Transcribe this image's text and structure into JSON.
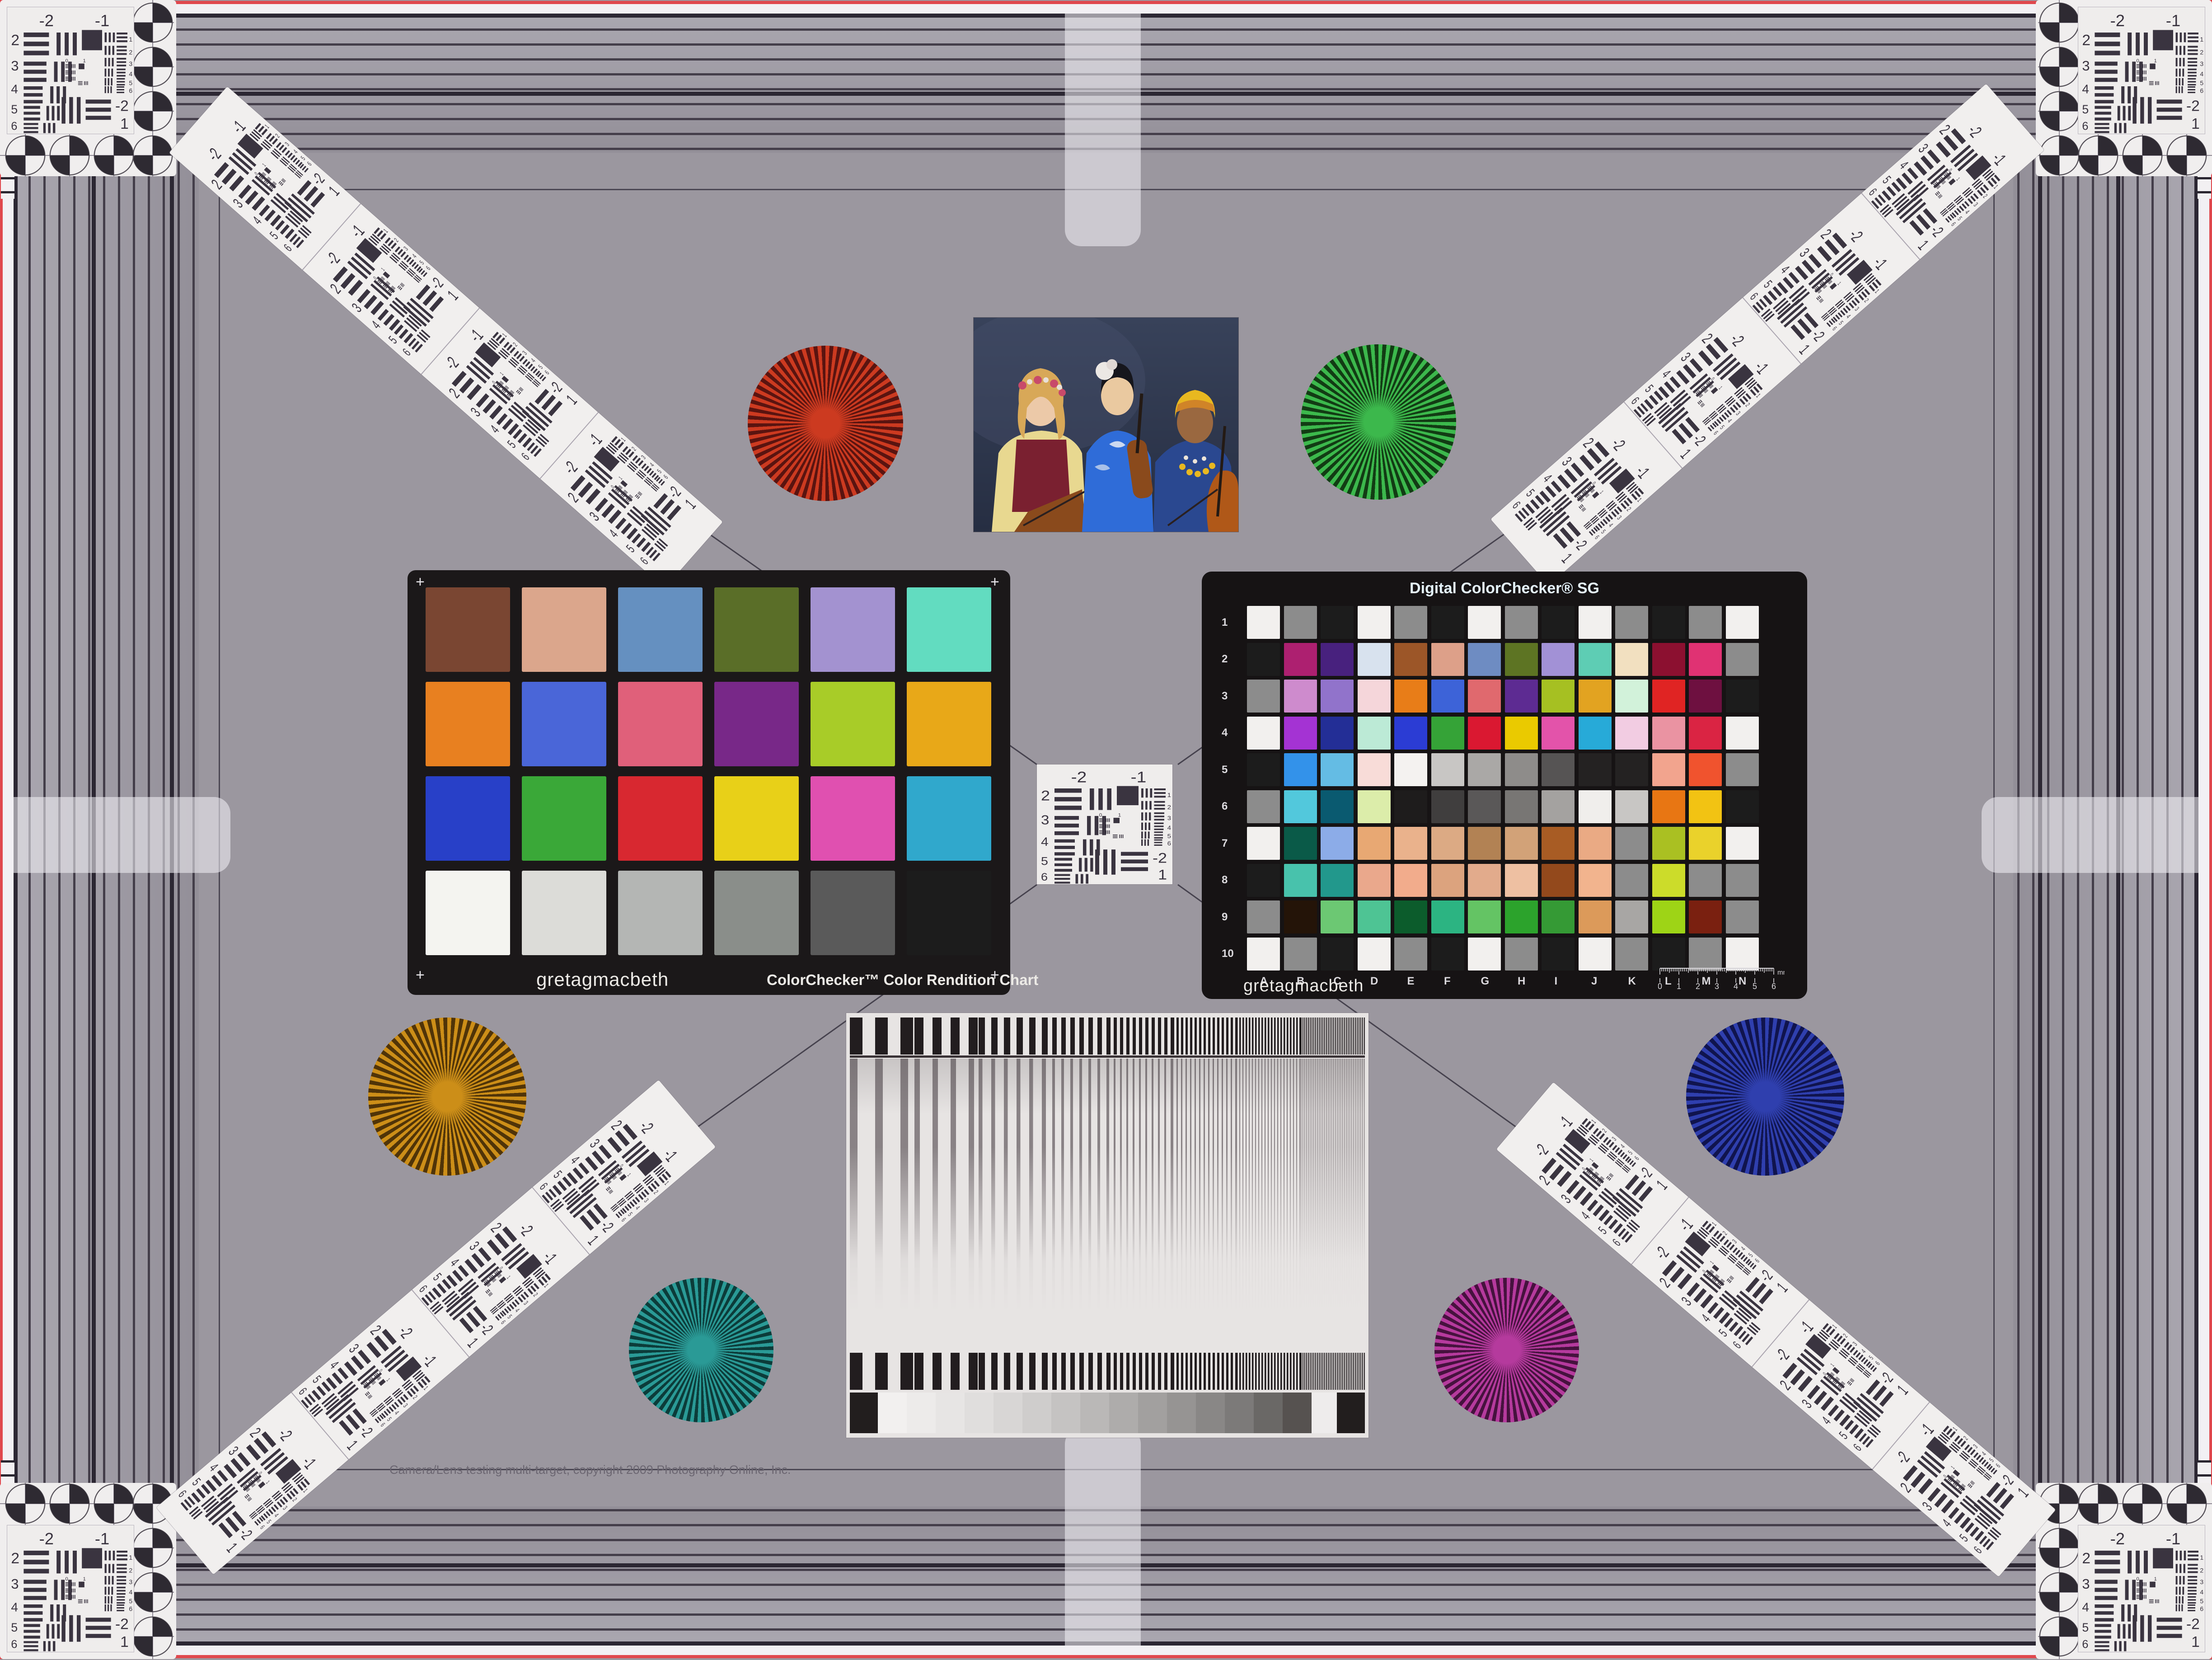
{
  "copyright_line": "Camera/Lens testing multi-target, copyright 2009 Photography Online, Inc.",
  "colors": {
    "field": "#9b979f",
    "stripe_line": "#443e4a",
    "pink_edge": "#e0484e",
    "card_black": "#1b1819",
    "white_card": "#efedec",
    "inner_frame": "#4b4753"
  },
  "classic_checker": {
    "brand": "gretagmacbeth",
    "title": "ColorChecker™ Color Rendition Chart",
    "patches": [
      "#7a4632",
      "#dba68c",
      "#6590c0",
      "#5a6e28",
      "#a392d0",
      "#62dcc0",
      "#e88020",
      "#4a66d8",
      "#e0607a",
      "#782888",
      "#a8cc28",
      "#e8a818",
      "#2840c8",
      "#3aa838",
      "#d82830",
      "#e8d018",
      "#e050b0",
      "#30a8cc",
      "#f4f4f0",
      "#dcdcd8",
      "#b4b6b4",
      "#8a8e8a",
      "#5a5a5a",
      "#1c1c1c"
    ]
  },
  "sg_checker": {
    "title": "Digital ColorChecker® SG",
    "brand": "gretagmacbeth",
    "row_labels": [
      "1",
      "2",
      "3",
      "4",
      "5",
      "6",
      "7",
      "8",
      "9",
      "10"
    ],
    "col_labels": [
      "A",
      "B",
      "C",
      "D",
      "E",
      "F",
      "G",
      "H",
      "I",
      "J",
      "K",
      "L",
      "M",
      "N"
    ],
    "ruler_numbers": [
      "0",
      "1",
      "2",
      "3",
      "4",
      "5",
      "6"
    ],
    "ruler_unit": "mm",
    "patches": [
      [
        "#f2f0ee",
        "#8c8c8c",
        "#1c1c1c",
        "#f2f0ee",
        "#8c8c8c",
        "#1c1c1c",
        "#f2f0ee",
        "#8c8c8c",
        "#1c1c1c",
        "#f2f0ee",
        "#8c8c8c",
        "#1c1c1c",
        "#8c8c8c",
        "#f2f0ee"
      ],
      [
        "#1c1c1c",
        "#ad2070",
        "#48217e",
        "#d8e2ee",
        "#9c5628",
        "#dda089",
        "#6e8cc2",
        "#5d7423",
        "#a291d6",
        "#5ecdb4",
        "#f2e0c0",
        "#8c1030",
        "#e03273",
        "#8c8c8c"
      ],
      [
        "#8c8c8c",
        "#ce8bcd",
        "#9173cb",
        "#f5d6da",
        "#e87d18",
        "#3d63d8",
        "#e0696e",
        "#5d2b92",
        "#a6c022",
        "#e2a321",
        "#d2f2da",
        "#e02423",
        "#6e1040",
        "#1c1c1c"
      ],
      [
        "#f2f0ee",
        "#a433d3",
        "#232e96",
        "#bcead6",
        "#2b3cd4",
        "#35a337",
        "#da1831",
        "#eaca00",
        "#e353aa",
        "#27aad8",
        "#f2cce2",
        "#ea93a2",
        "#da2443",
        "#f2f0ee"
      ],
      [
        "#1c1c1c",
        "#3392ea",
        "#64bce4",
        "#f8dcd8",
        "#f4f2f0",
        "#c8c6c4",
        "#aaa8a6",
        "#8e8c8a",
        "#565454",
        "#242222",
        "#242222",
        "#f2a48e",
        "#f0532e",
        "#8c8c8c"
      ],
      [
        "#8c8c8c",
        "#52c8dc",
        "#0a5a70",
        "#dcedaa",
        "#1e1c1c",
        "#403e3e",
        "#5a5858",
        "#787674",
        "#a4a2a0",
        "#f0eeec",
        "#c8c6c4",
        "#e87613",
        "#f2c313",
        "#1c1c1c"
      ],
      [
        "#f2f0ee",
        "#0a5a48",
        "#8cace8",
        "#e8a873",
        "#eab28c",
        "#dcaa84",
        "#b28254",
        "#d2a278",
        "#a85c24",
        "#eaaa84",
        "#8c8c8c",
        "#aac022",
        "#ead22b",
        "#f2f0ee"
      ],
      [
        "#1c1c1c",
        "#48c2ac",
        "#22988c",
        "#eaa88c",
        "#f2ac8c",
        "#dca37e",
        "#e2ab8c",
        "#eec0a2",
        "#93491c",
        "#f2b48e",
        "#8c8c8c",
        "#ccdc2a",
        "#8c8c8c",
        "#8c8c8c"
      ],
      [
        "#8c8c8c",
        "#241408",
        "#6cc873",
        "#4ec494",
        "#0c5c2c",
        "#2cb482",
        "#64c464",
        "#2ca32c",
        "#359a35",
        "#dc9a5a",
        "#a8a6a4",
        "#9ed416",
        "#7a2010",
        "#8c8c8c"
      ],
      [
        "#f2f0ee",
        "#8c8c8c",
        "#1c1c1c",
        "#f2f0ee",
        "#8c8c8c",
        "#1c1c1c",
        "#f2f0ee",
        "#8c8c8c",
        "#1c1c1c",
        "#f2f0ee",
        "#8c8c8c",
        "#1c1c1c",
        "#8c8c8c",
        "#f2f0ee"
      ]
    ]
  },
  "usaf_target": {
    "top_left_label": "-2",
    "top_right_label": "-1",
    "left_labels": [
      "2",
      "3",
      "4",
      "5",
      "6"
    ],
    "right_labels": [
      "1",
      "2",
      "3",
      "4",
      "5",
      "6"
    ],
    "bottom_labels": [
      "-2",
      "1"
    ],
    "inner_labels": [
      "0",
      "1"
    ]
  },
  "siemens_stars": [
    {
      "name": "red",
      "bright": "#cc3a20",
      "dark": "#5a1410"
    },
    {
      "name": "green",
      "bright": "#3cb84c",
      "dark": "#123c14"
    },
    {
      "name": "amber",
      "bright": "#cc8e18",
      "dark": "#503408"
    },
    {
      "name": "blue",
      "bright": "#2f3fae",
      "dark": "#10144e"
    },
    {
      "name": "teal",
      "bright": "#2a9a96",
      "dark": "#0c3c3a"
    },
    {
      "name": "magenta",
      "bright": "#b53a9d",
      "dark": "#46123e"
    }
  ],
  "sweep_chart": {
    "bar_color": "#221d1f",
    "card_color": "#e7e4e3",
    "wedge_steps": [
      "#f2f0ef",
      "#edebea",
      "#e7e5e4",
      "#e0dedd",
      "#d8d6d5",
      "#cfcdcc",
      "#c5c3c2",
      "#bab8b7",
      "#aeacab",
      "#a2a09f",
      "#969493",
      "#898786",
      "#7c7a79",
      "#6a6866",
      "#565250"
    ],
    "wedge_end_black": "#221e1e",
    "wedge_gap_white": "#eeecec"
  },
  "photo": {
    "subject": "three women musicians in folk costume with violins and cello",
    "palette": {
      "backdrop": "#38425a",
      "backdrop_dark": "#262e42",
      "skin_light": "#ecc9a8",
      "skin_mid": "#eac9a0",
      "skin_dark": "#9a6840",
      "hair_blonde": "#d8a858",
      "hair_black": "#16161c",
      "blouse_yellow": "#e8d890",
      "vest_red": "#7a2030",
      "kimono_blue": "#2f6cd8",
      "garment_blue": "#2a4890",
      "headwrap_yellow": "#e8b820",
      "cello_brown": "#b05818"
    }
  }
}
